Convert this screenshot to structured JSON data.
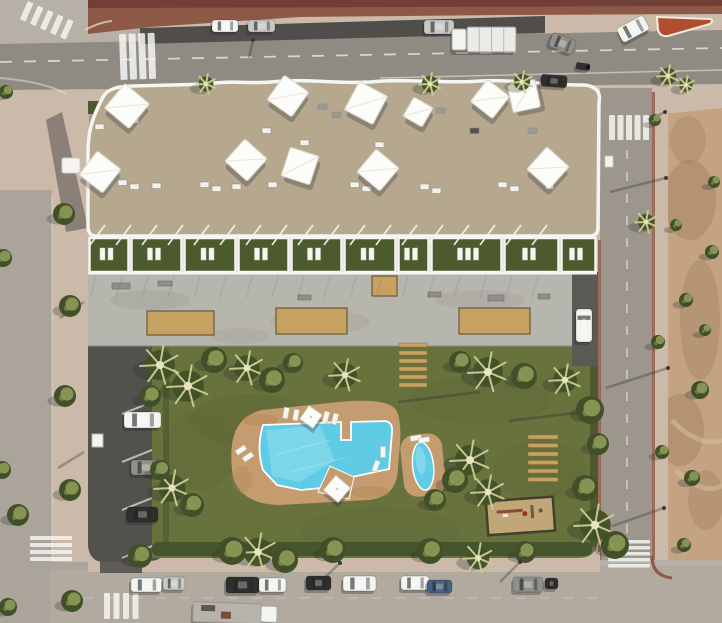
{
  "scene": {
    "type": "aerial-architectural-render",
    "subject": "bird's-eye render of a white apartment complex with rooftop shade sails, ground-floor garden terraces, a landscaped courtyard with a freeform swimming pool, a children's pool, a playground, resident parking and surrounding streets with traffic"
  },
  "palette": {
    "junction": "#b6b0a6",
    "asphaltDark": "#504e4a",
    "roadTop": "#8f8a82",
    "roadLeft": "#aba49a",
    "roadRight": "#9c968d",
    "roadBottom": "#b2aa9e",
    "sidewalk": "#cbb9a9",
    "redPave": "#8e5847",
    "redPaveDark": "#6e3d33",
    "redIsland": "#b14e30",
    "dirt": "#c3a382",
    "dirtDark": "#9a7a5b",
    "white": "#f4f3ef",
    "roof": "#b6a88e",
    "roofLight": "#c8bca3",
    "roofGray": "#a59b8a",
    "darkRoof": "#32302c",
    "terraceLawn": "#4d5a2d",
    "deck": "#b6b5ae",
    "deckShade": "#9f9d95",
    "planter": "#c7a162",
    "lawn": "#68723c",
    "lawnDark": "#566130",
    "treeDark": "#42502a",
    "treeLight": "#8d9b56",
    "palmLight": "#cbcf90",
    "poolDeck": "#c59c6f",
    "poolDeckDark": "#ac8254",
    "water": "#5fcbe4",
    "waterLight": "#a5e6f2",
    "sand": "#c1a777",
    "parking": "#53514c",
    "shadow": "#23252a",
    "lineWhite": "#f5f5f2",
    "carWhite": "#f4f4f1",
    "carSilver": "#c8c8c5",
    "carDark": "#2f2f2e",
    "carBlue": "#46627e",
    "carGray": "#90908b",
    "driveway": "#5b5954"
  },
  "roof": {
    "sails": [
      [
        127,
        106,
        32,
        40
      ],
      [
        100,
        172,
        30,
        38
      ],
      [
        288,
        96,
        30,
        35
      ],
      [
        366,
        103,
        32,
        28
      ],
      [
        418,
        112,
        22,
        30
      ],
      [
        490,
        99,
        28,
        38
      ],
      [
        524,
        96,
        28,
        -12
      ],
      [
        246,
        160,
        30,
        42
      ],
      [
        300,
        166,
        30,
        18
      ],
      [
        378,
        170,
        30,
        40
      ],
      [
        548,
        168,
        30,
        42
      ]
    ],
    "items": [
      [
        318,
        104,
        "g"
      ],
      [
        332,
        112,
        "g"
      ],
      [
        414,
        118,
        "w"
      ],
      [
        436,
        108,
        "g"
      ],
      [
        470,
        128,
        "d"
      ],
      [
        528,
        128,
        "g"
      ],
      [
        262,
        128,
        "w"
      ],
      [
        130,
        118,
        "w"
      ],
      [
        95,
        124,
        "w"
      ],
      [
        118,
        180,
        "w"
      ],
      [
        130,
        184,
        "w"
      ],
      [
        152,
        183,
        "w"
      ],
      [
        200,
        182,
        "w"
      ],
      [
        212,
        186,
        "w"
      ],
      [
        232,
        184,
        "w"
      ],
      [
        268,
        182,
        "w"
      ],
      [
        350,
        182,
        "w"
      ],
      [
        362,
        186,
        "w"
      ],
      [
        420,
        184,
        "w"
      ],
      [
        432,
        188,
        "w"
      ],
      [
        498,
        182,
        "w"
      ],
      [
        510,
        186,
        "w"
      ],
      [
        545,
        184,
        "w"
      ],
      [
        375,
        142,
        "w"
      ],
      [
        300,
        140,
        "w"
      ]
    ]
  },
  "terraces": {
    "bounds": [
      88,
      130,
      183,
      237,
      290,
      343,
      397,
      430,
      503,
      560,
      597
    ],
    "y": 238,
    "h": 34
  },
  "pergola": {
    "x0": 90,
    "x1": 556,
    "step": 26
  },
  "deck": {
    "planters": [
      [
        147,
        311,
        67,
        24
      ],
      [
        276,
        308,
        71,
        26
      ],
      [
        459,
        308,
        71,
        26
      ],
      [
        372,
        276,
        25,
        20
      ]
    ],
    "benches": [
      [
        112,
        283,
        18,
        6
      ],
      [
        158,
        281,
        14,
        5
      ],
      [
        298,
        295,
        13,
        5
      ],
      [
        428,
        292,
        13,
        5
      ],
      [
        488,
        295,
        16,
        6
      ],
      [
        538,
        294,
        12,
        5
      ]
    ]
  },
  "planks": [
    {
      "x": 399,
      "y": 343,
      "w": 28,
      "h": 4,
      "n": 6,
      "gap": 8
    },
    {
      "x": 528,
      "y": 435,
      "w": 30,
      "h": 4,
      "n": 6,
      "gap": 8.5
    }
  ],
  "pool": {
    "loungers": [
      [
        286,
        413,
        10
      ],
      [
        296,
        415,
        10
      ],
      [
        326,
        417,
        15
      ],
      [
        335,
        419,
        15
      ],
      [
        241,
        450,
        55
      ],
      [
        248,
        457,
        55
      ],
      [
        383,
        452,
        0
      ],
      [
        376,
        466,
        20
      ],
      [
        416,
        438,
        80
      ],
      [
        424,
        440,
        80
      ]
    ],
    "parasols": [
      [
        311,
        417,
        16,
        35
      ],
      [
        337,
        489,
        19,
        40
      ]
    ]
  },
  "trees": [
    [
      160,
      365,
      "p",
      20
    ],
    [
      188,
      386,
      "p",
      21
    ],
    [
      214,
      360,
      "b",
      13
    ],
    [
      150,
      396,
      "b",
      11
    ],
    [
      247,
      368,
      "p",
      17
    ],
    [
      272,
      380,
      "b",
      13
    ],
    [
      293,
      363,
      "b",
      10
    ],
    [
      345,
      375,
      "p",
      16
    ],
    [
      460,
      362,
      "b",
      11
    ],
    [
      488,
      372,
      "p",
      20
    ],
    [
      524,
      376,
      "b",
      13
    ],
    [
      565,
      380,
      "p",
      16
    ],
    [
      470,
      460,
      "p",
      20
    ],
    [
      455,
      480,
      "b",
      13
    ],
    [
      488,
      492,
      "p",
      17
    ],
    [
      435,
      500,
      "b",
      11
    ],
    [
      590,
      410,
      "b",
      14
    ],
    [
      598,
      444,
      "b",
      11
    ],
    [
      172,
      488,
      "p",
      18
    ],
    [
      192,
      505,
      "b",
      12
    ],
    [
      160,
      470,
      "b",
      10
    ],
    [
      258,
      552,
      "p",
      19
    ],
    [
      285,
      560,
      "b",
      13
    ],
    [
      478,
      558,
      "p",
      15
    ],
    [
      585,
      488,
      "b",
      13
    ],
    [
      595,
      525,
      "p",
      21
    ],
    [
      615,
      545,
      "b",
      14
    ],
    [
      140,
      556,
      "b",
      12
    ],
    [
      232,
      551,
      "b",
      14
    ],
    [
      333,
      550,
      "b",
      13
    ],
    [
      430,
      551,
      "b",
      13
    ],
    [
      525,
      552,
      "b",
      11
    ],
    [
      72,
      601,
      "b",
      11
    ],
    [
      18,
      515,
      "b",
      11
    ],
    [
      64,
      214,
      "b",
      11
    ],
    [
      70,
      306,
      "b",
      11
    ],
    [
      65,
      396,
      "b",
      11
    ],
    [
      70,
      490,
      "b",
      11
    ],
    [
      3,
      258,
      "b",
      9
    ],
    [
      2,
      470,
      "b",
      9
    ],
    [
      8,
      607,
      "b",
      9
    ],
    [
      6,
      92,
      "b",
      7
    ],
    [
      206,
      84,
      "p",
      10
    ],
    [
      430,
      84,
      "p",
      11
    ],
    [
      522,
      82,
      "p",
      11
    ],
    [
      646,
      222,
      "p",
      11
    ],
    [
      668,
      76,
      "p",
      11
    ],
    [
      686,
      85,
      "p",
      9
    ],
    [
      658,
      342,
      "b",
      7
    ],
    [
      662,
      452,
      "b",
      7
    ],
    [
      655,
      120,
      "b",
      6
    ],
    [
      700,
      390,
      "b",
      9
    ],
    [
      686,
      300,
      "b",
      7
    ],
    [
      712,
      252,
      "b",
      7
    ],
    [
      692,
      478,
      "b",
      8
    ],
    [
      714,
      182,
      "b",
      6
    ],
    [
      684,
      545,
      "b",
      7
    ],
    [
      676,
      225,
      "b",
      6
    ],
    [
      705,
      330,
      "b",
      6
    ]
  ],
  "vehicles": [
    {
      "name": "parked-car",
      "x": 212,
      "y": 20,
      "w": 26,
      "h": 12,
      "rot": 0,
      "color": "carWhite",
      "kind": "car"
    },
    {
      "name": "parked-car",
      "x": 248,
      "y": 20,
      "w": 27,
      "h": 12,
      "rot": 0,
      "color": "carSilver",
      "kind": "car"
    },
    {
      "name": "sedan",
      "x": 424,
      "y": 20,
      "w": 30,
      "h": 14,
      "rot": 0,
      "color": "carSilver",
      "kind": "car"
    },
    {
      "name": "flatbed-truck",
      "x": 452,
      "y": 27,
      "w": 64,
      "h": 25,
      "rot": 0,
      "color": "carWhite",
      "kind": "truck",
      "cab": "left"
    },
    {
      "name": "van",
      "x": 550,
      "y": 36,
      "w": 25,
      "h": 15,
      "rot": 22,
      "color": "carGray",
      "kind": "car"
    },
    {
      "name": "turning-car",
      "x": 618,
      "y": 21,
      "w": 30,
      "h": 16,
      "rot": -28,
      "color": "carWhite",
      "kind": "car"
    },
    {
      "name": "sedan",
      "x": 541,
      "y": 75,
      "w": 26,
      "h": 12,
      "rot": 4,
      "color": "carDark",
      "kind": "car"
    },
    {
      "name": "motorcycle",
      "x": 576,
      "y": 63,
      "w": 14,
      "h": 7,
      "rot": 8,
      "color": "carDark",
      "kind": "moto"
    },
    {
      "name": "parked-car",
      "x": 124,
      "y": 412,
      "w": 37,
      "h": 16,
      "rot": 0,
      "color": "carWhite",
      "kind": "car"
    },
    {
      "name": "parked-car",
      "x": 131,
      "y": 460,
      "w": 30,
      "h": 15,
      "rot": 0,
      "color": "carGray",
      "kind": "car"
    },
    {
      "name": "parked-car",
      "x": 127,
      "y": 507,
      "w": 31,
      "h": 15,
      "rot": 0,
      "color": "carDark",
      "kind": "car"
    },
    {
      "name": "driveway-car",
      "x": 576,
      "y": 309,
      "w": 16,
      "h": 33,
      "rot": 0,
      "color": "carWhite",
      "kind": "car"
    },
    {
      "name": "parked-car",
      "x": 131,
      "y": 578,
      "w": 31,
      "h": 14,
      "rot": 0,
      "color": "carWhite",
      "kind": "car"
    },
    {
      "name": "parked-car",
      "x": 163,
      "y": 577,
      "w": 22,
      "h": 13,
      "rot": 0,
      "color": "carSilver",
      "kind": "car"
    },
    {
      "name": "parked-car",
      "x": 226,
      "y": 577,
      "w": 33,
      "h": 16,
      "rot": 0,
      "color": "carDark",
      "kind": "car"
    },
    {
      "name": "parked-car",
      "x": 259,
      "y": 578,
      "w": 27,
      "h": 14,
      "rot": 0,
      "color": "carWhite",
      "kind": "car"
    },
    {
      "name": "parked-car",
      "x": 306,
      "y": 576,
      "w": 25,
      "h": 14,
      "rot": 0,
      "color": "carDark",
      "kind": "car"
    },
    {
      "name": "parked-car",
      "x": 343,
      "y": 576,
      "w": 33,
      "h": 15,
      "rot": 0,
      "color": "carWhite",
      "kind": "car"
    },
    {
      "name": "parked-car",
      "x": 401,
      "y": 576,
      "w": 28,
      "h": 14,
      "rot": 0,
      "color": "carWhite",
      "kind": "car"
    },
    {
      "name": "parked-car",
      "x": 427,
      "y": 580,
      "w": 25,
      "h": 13,
      "rot": 0,
      "color": "carBlue",
      "kind": "car"
    },
    {
      "name": "parked-car",
      "x": 513,
      "y": 577,
      "w": 30,
      "h": 15,
      "rot": 0,
      "color": "carGray",
      "kind": "car"
    },
    {
      "name": "parked-car",
      "x": 545,
      "y": 578,
      "w": 13,
      "h": 11,
      "rot": 0,
      "color": "carDark",
      "kind": "car"
    },
    {
      "name": "work-truck",
      "x": 193,
      "y": 603,
      "w": 84,
      "h": 20,
      "rot": 2,
      "color": "carWhite",
      "kind": "truck",
      "cab": "right"
    }
  ],
  "crosswalks": [
    {
      "x": 119,
      "y": 34,
      "n": 4,
      "bw": 7,
      "bh": 46,
      "dx": 9.5,
      "dy": 0,
      "rot": -2
    },
    {
      "x": 609,
      "y": 115,
      "n": 5,
      "bw": 6,
      "bh": 25,
      "dx": 8.5,
      "dy": 0,
      "rot": 0
    },
    {
      "x": 608,
      "y": 540,
      "n": 5,
      "bw": 42,
      "bh": 3.5,
      "dx": 0,
      "dy": 6,
      "rot": 0
    },
    {
      "x": 30,
      "y": 536,
      "n": 4,
      "bw": 42,
      "bh": 4,
      "dx": 0,
      "dy": 7,
      "rot": 0
    },
    {
      "x": 28,
      "y": 1,
      "n": 5,
      "bw": 6,
      "bh": 20,
      "dx": 11,
      "dy": 0,
      "rot": 24
    },
    {
      "x": 104,
      "y": 593,
      "n": 4,
      "bw": 6,
      "bh": 26,
      "dx": 9.5,
      "dy": 0,
      "rot": 0
    }
  ],
  "parking": {
    "stall_line_ys": [
      398,
      446,
      494,
      542
    ],
    "white_box": [
      92,
      434,
      11,
      13
    ]
  },
  "shadows": {
    "lamp_lines": [
      [
        253,
        40,
        249,
        58
      ],
      [
        665,
        112,
        648,
        120
      ],
      [
        666,
        178,
        610,
        192
      ],
      [
        668,
        368,
        606,
        388
      ],
      [
        664,
        508,
        612,
        526
      ],
      [
        340,
        563,
        318,
        584
      ],
      [
        520,
        562,
        500,
        582
      ],
      [
        480,
        392,
        398,
        402
      ],
      [
        591,
        411,
        509,
        421
      ],
      [
        84,
        302,
        60,
        318
      ],
      [
        84,
        452,
        58,
        468
      ]
    ]
  }
}
